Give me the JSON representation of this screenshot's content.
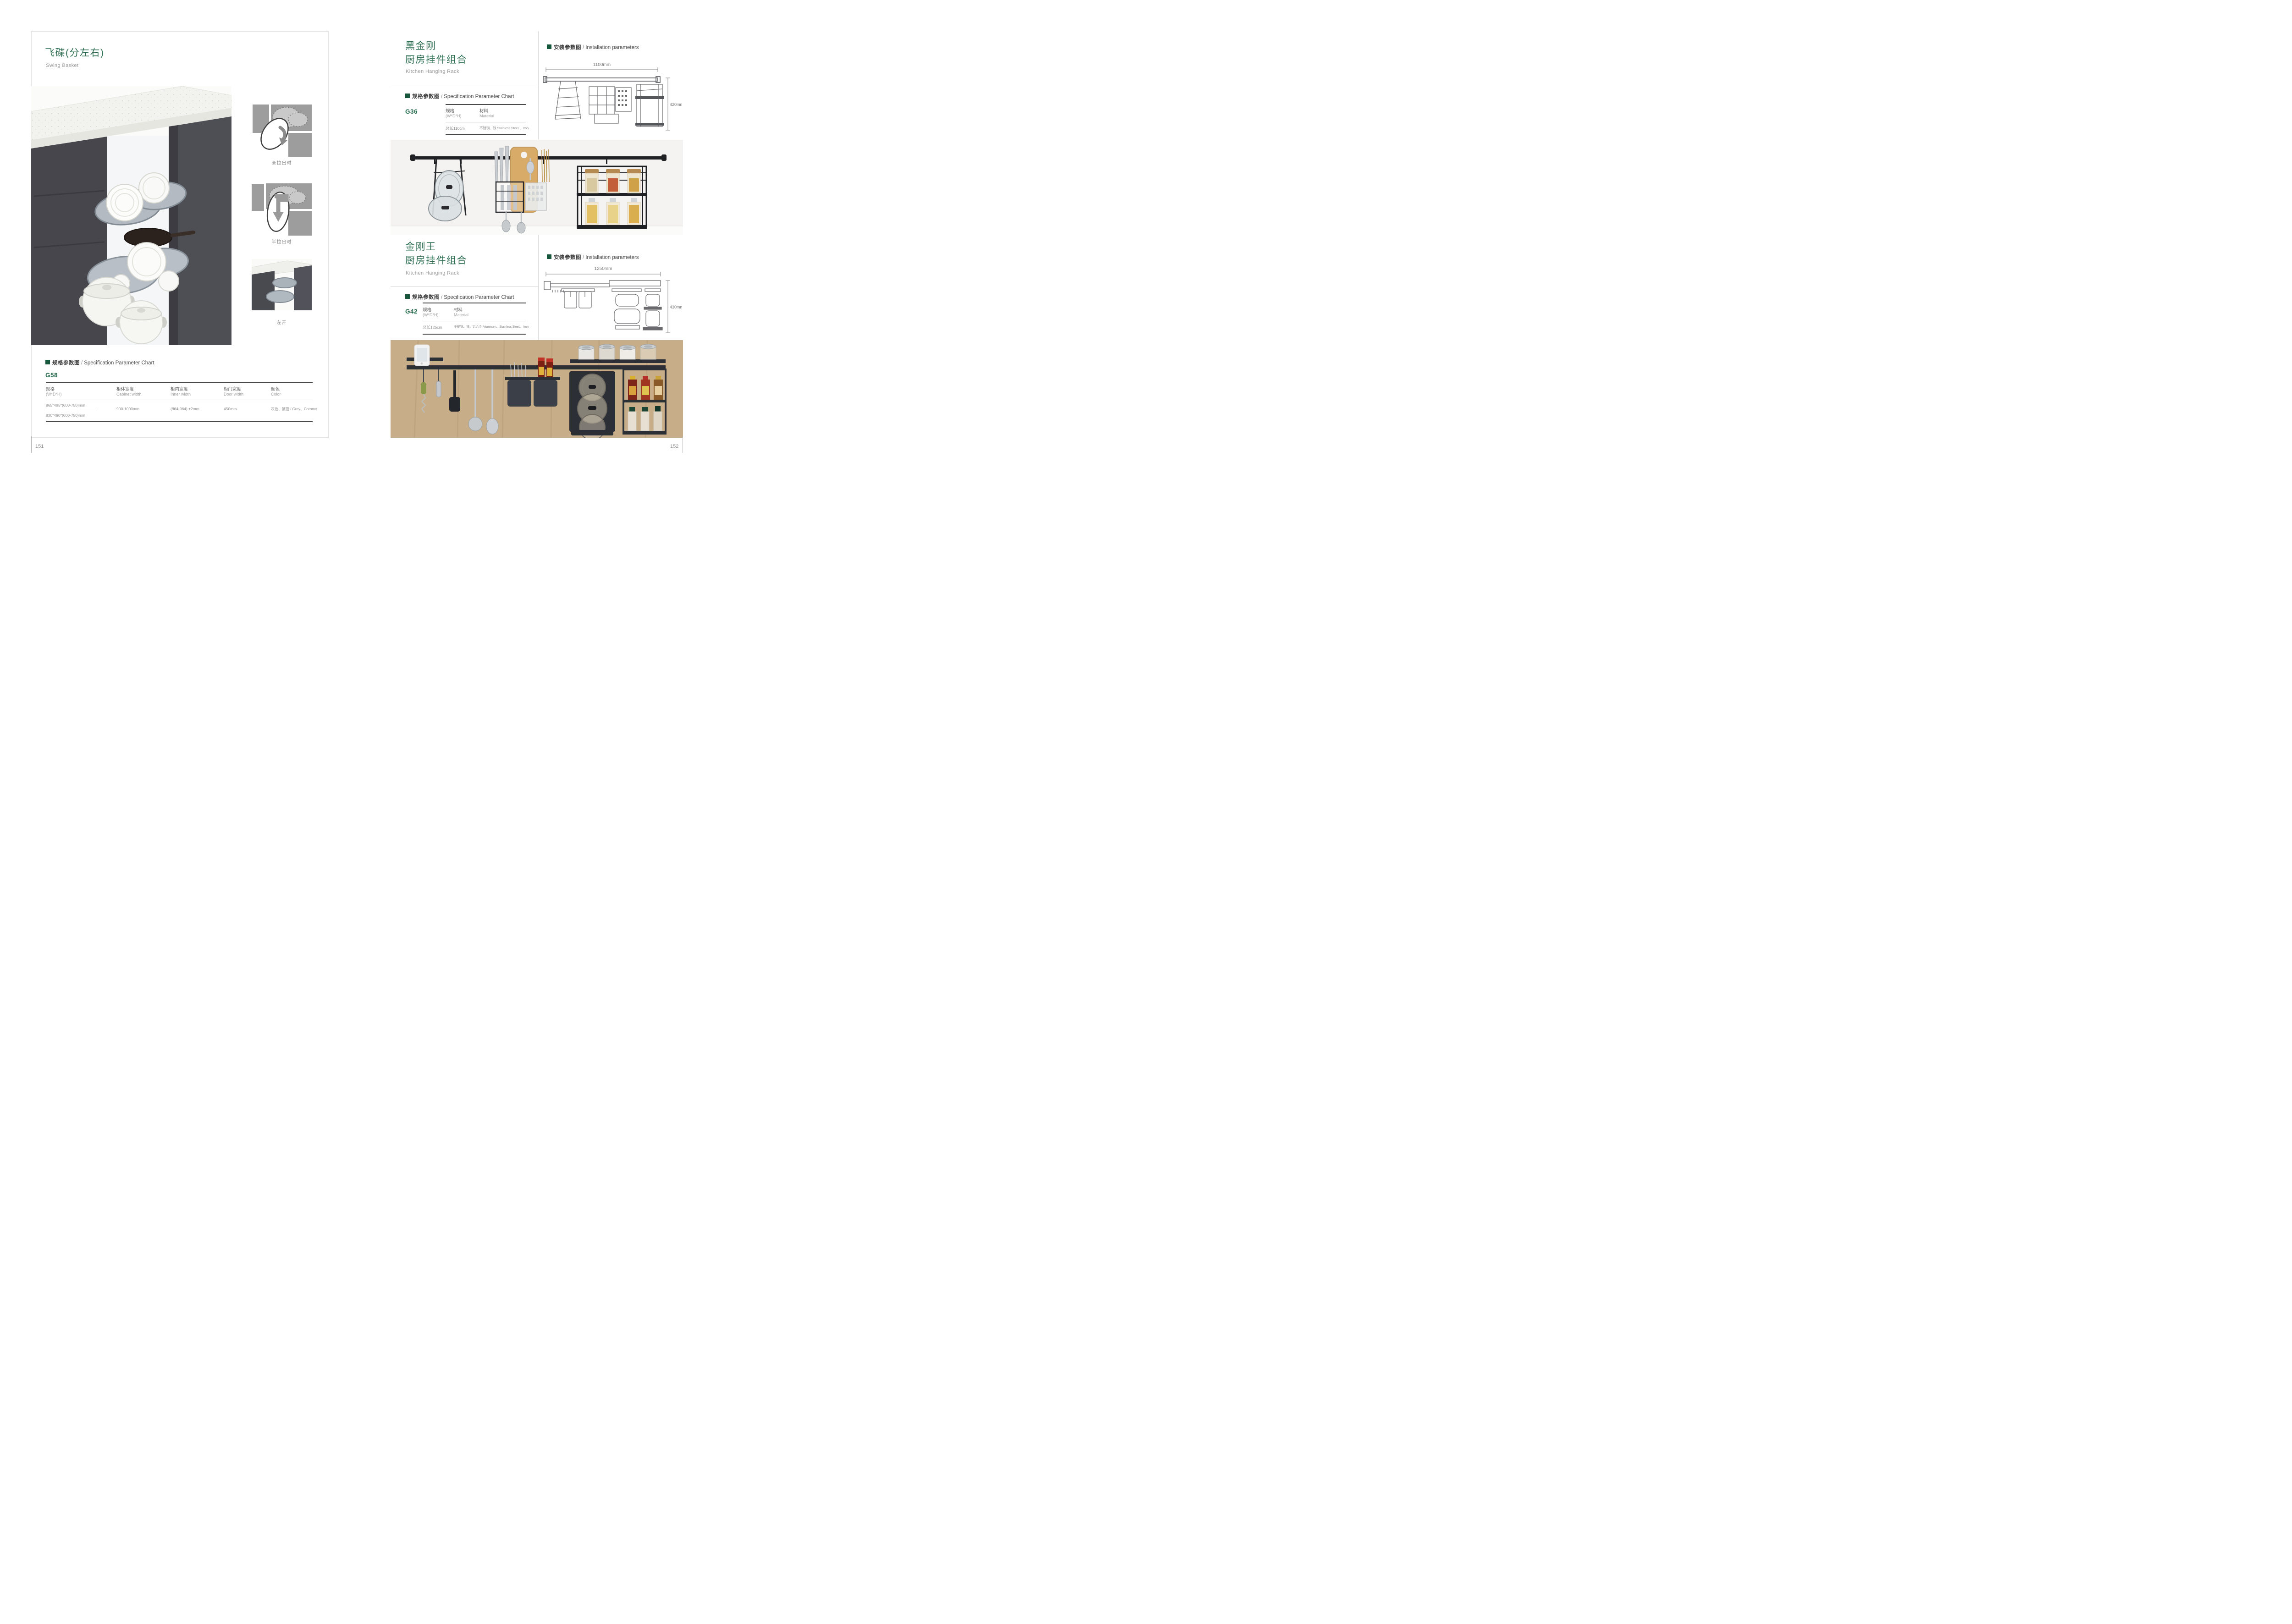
{
  "shared": {
    "slash": "/",
    "spec_header_cn": "规格参数图",
    "spec_header_en": "Specification Parameter Chart",
    "install_header_cn": "安装参数图",
    "install_header_en": "Installation parameters"
  },
  "left_page": {
    "page_number": "151",
    "title": "飞碟(分左右)",
    "subtitle": "Swing Basket",
    "captions": [
      "全拉出时",
      "半拉出时",
      "左开"
    ],
    "model": "G58",
    "table": {
      "col_spec_cn": "规格",
      "col_spec_en": "(W*D*H)",
      "col_cabinet_cn": "柜体宽度",
      "col_cabinet_en": "Cabinet width",
      "col_inner_cn": "柜内宽度",
      "col_inner_en": "Inner width",
      "col_door_cn": "柜门宽度",
      "col_door_en": "Door width",
      "col_color_cn": "颜色",
      "col_color_en": "Color",
      "spec_value_1": "865*495*(600-750)mm",
      "spec_value_2": "830*490*(600-750)mm",
      "cabinet_width": "900-1000mm",
      "inner_width": "(864-964) ±2mm",
      "door_width": "450mm",
      "color": "灰色、镀铬 / Grey、Chrome"
    }
  },
  "right_page": {
    "page_number": "152",
    "sections": [
      {
        "title_line1": "黑金刚",
        "title_line2": "厨房挂件组合",
        "subtitle": "Kitchen Hanging Rack",
        "model": "G36",
        "dim_width": "1100mm",
        "dim_height": "420mm",
        "col_spec_cn": "规格",
        "col_spec_en": "(W*D*H)",
        "col_material_cn": "材料",
        "col_material_en": "Material",
        "spec_value": "总长110cm",
        "material_value": "不锈钢、铁  Stainless SteeL、Iron"
      },
      {
        "title_line1": "金刚王",
        "title_line2": "厨房挂件组合",
        "subtitle": "Kitchen Hanging Rack",
        "model": "G42",
        "dim_width": "1250mm",
        "dim_height": "430mm",
        "col_spec_cn": "规格",
        "col_spec_en": "(W*D*H)",
        "col_material_cn": "材料",
        "col_material_en": "Material",
        "spec_value": "总长125cm",
        "material_value": "不锈钢、铁、铝合金  Aluminum、Stainless SteeL、Iron"
      }
    ]
  }
}
